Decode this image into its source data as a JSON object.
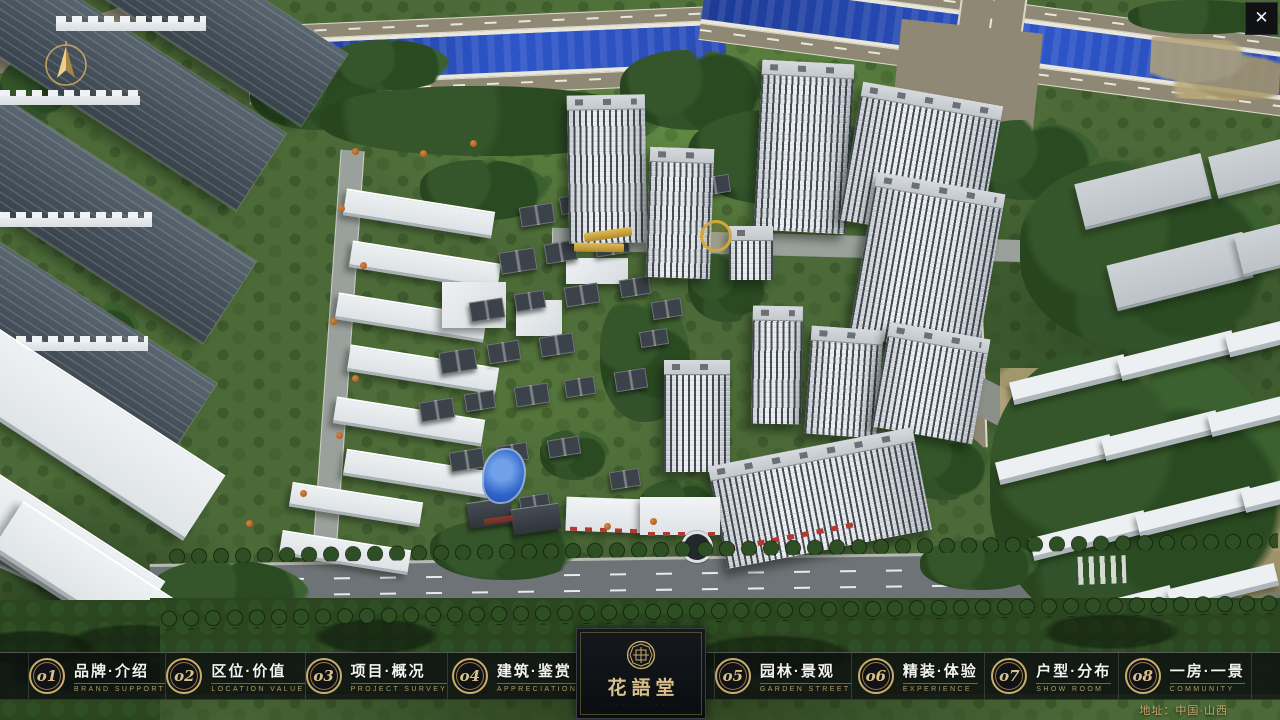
{
  "nav": {
    "items": [
      {
        "num": "o1",
        "zh": "品牌·介绍",
        "en": "BRAND SUPPORT"
      },
      {
        "num": "o2",
        "zh": "区位·价值",
        "en": "LOCATION VALUE"
      },
      {
        "num": "o3",
        "zh": "项目·概况",
        "en": "PROJECT SURVEY"
      },
      {
        "num": "o4",
        "zh": "建筑·鉴赏",
        "en": "APPRECIATION"
      },
      {
        "num": "o5",
        "zh": "园林·景观",
        "en": "GARDEN STREET"
      },
      {
        "num": "o6",
        "zh": "精装·体验",
        "en": "EXPERIENCE"
      },
      {
        "num": "o7",
        "zh": "户型·分布",
        "en": "SHOW ROOM"
      },
      {
        "num": "o8",
        "zh": "一房·一景",
        "en": "COMMUNITY"
      }
    ]
  },
  "logo": {
    "title": "花語堂",
    "tagline": "· · · · · · · · · · · ·"
  },
  "footer": {
    "address": "地址：中国·山西"
  },
  "window": {
    "close_label": "✕"
  },
  "icons": {
    "compass": "compass-north-icon",
    "close": "close-icon",
    "seal": "brand-seal-icon"
  },
  "colors": {
    "accent_gold": "#c9ad6a",
    "bar_background": "rgba(12,14,16,0.78)",
    "river_blue": "#2a4cb8",
    "road_tan": "#8f8874",
    "logo_gold": "#d9bf8a"
  }
}
